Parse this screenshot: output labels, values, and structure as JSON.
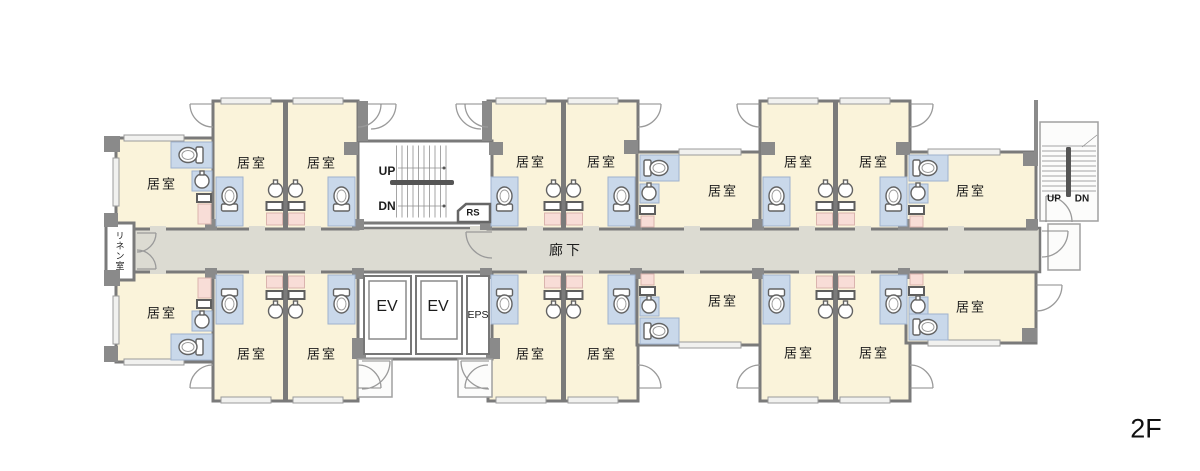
{
  "floor_label": "2F",
  "corridor_label": "廊下",
  "linen_room_label": "リネン室",
  "left_stair": {
    "up": "UP",
    "dn": "DN"
  },
  "right_stair": {
    "up": "UP",
    "dn": "DN"
  },
  "rs_label": "RS",
  "elevators": {
    "ev1": "EV",
    "ev2": "EV",
    "eps": "EPS"
  },
  "rooms": [
    {
      "label": "居室"
    },
    {
      "label": "居室"
    },
    {
      "label": "居室"
    },
    {
      "label": "居室"
    },
    {
      "label": "居室"
    },
    {
      "label": "居室"
    },
    {
      "label": "居室"
    },
    {
      "label": "居室"
    },
    {
      "label": "居室"
    },
    {
      "label": "居室"
    },
    {
      "label": "居室"
    },
    {
      "label": "居室"
    },
    {
      "label": "居室"
    },
    {
      "label": "居室"
    },
    {
      "label": "居室"
    },
    {
      "label": "居室"
    },
    {
      "label": "居室"
    },
    {
      "label": "居室"
    }
  ],
  "colors": {
    "room_fill": "#faf3da",
    "corridor_fill": "#dcdbd2",
    "wall": "#7a7a7a",
    "bath_fill": "#c9d8ea",
    "closet_pink": "#f8ddd7",
    "background": "#ffffff"
  }
}
